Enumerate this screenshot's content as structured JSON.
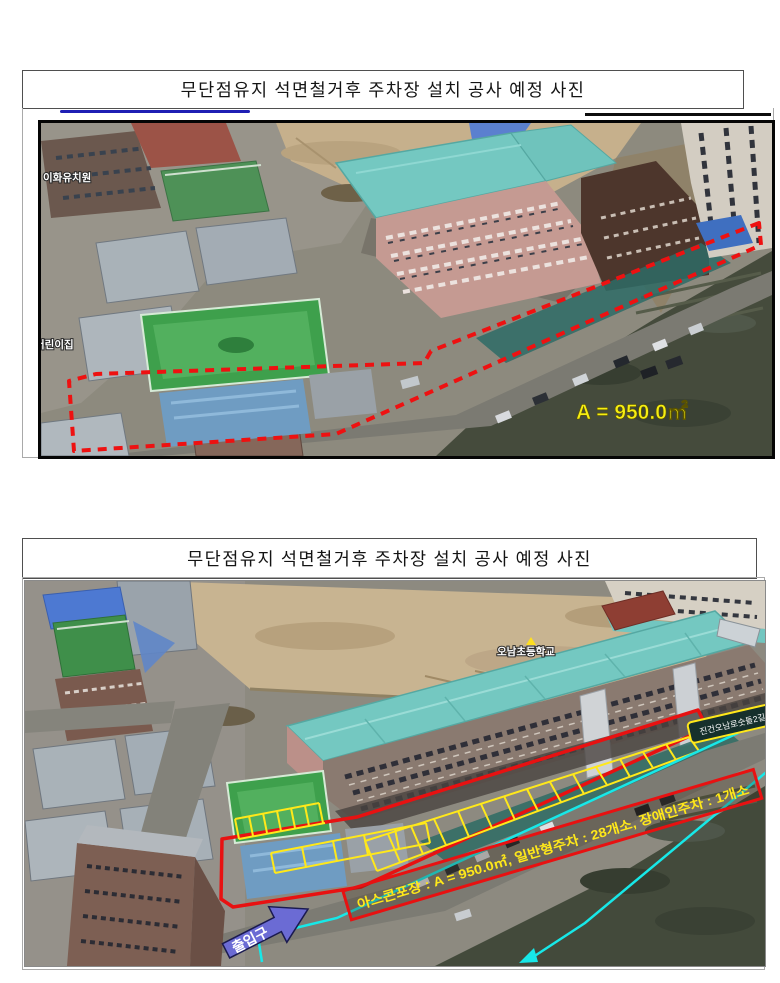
{
  "panels": {
    "top": {
      "title": "무단점유지 석면철거후 주차장 설치 공사 예정 사진",
      "photo": {
        "labels": {
          "kindergarten": "이화유치원",
          "daycare": "어린이집",
          "area": "A = 950.0㎡"
        }
      }
    },
    "bottom": {
      "title": "무단점유지 석면철거후 주차장 설치 공사 예정 사진",
      "photo": {
        "labels": {
          "school": "오남초등학교",
          "road_sign": "진건오남로숫돌2길",
          "entrance": "출입구",
          "spec": "아스콘포장 : A = 950.0㎡, 일반형주차 : 28개소, 장애인주차 : 1개소"
        }
      }
    }
  },
  "colors": {
    "outline_red": "#e81111",
    "stall_yellow": "#ffe81a",
    "area_text_yellow": "#f6ee12",
    "boundary_cyan": "#17e8e8",
    "arrow_blue": "#6b6bd4",
    "school_roof_teal": "#74c8c1"
  }
}
